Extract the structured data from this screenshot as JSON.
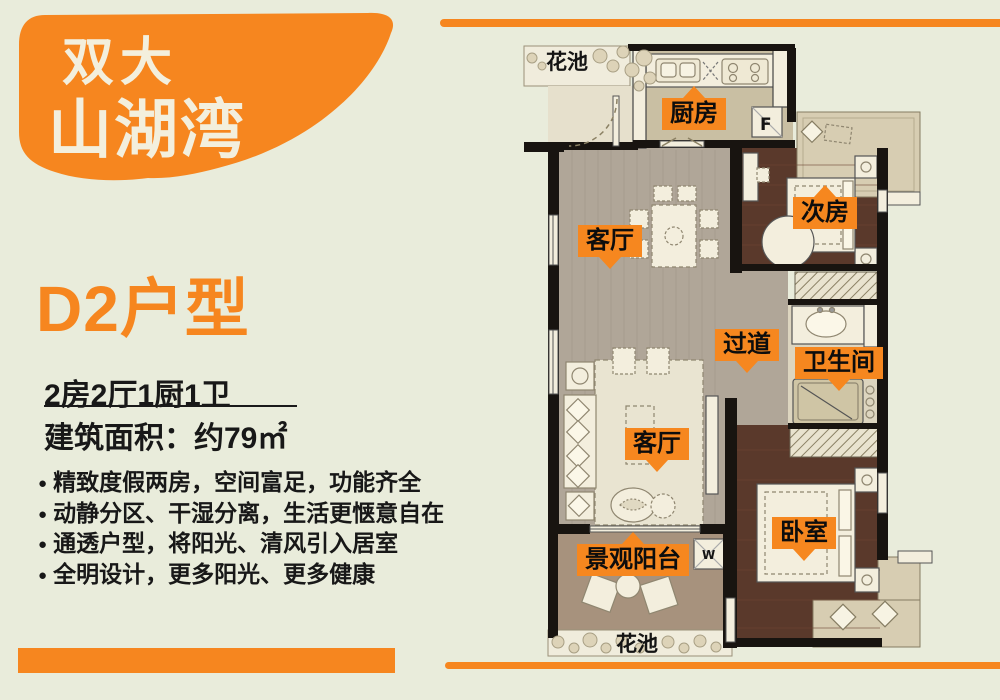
{
  "page": {
    "background": "#e9ecdb",
    "accent": "#f6861f"
  },
  "brand": {
    "line1": "双大",
    "line2": "山湖湾"
  },
  "unit": {
    "title": "D2户型",
    "spec": "2房2厅1厨1卫",
    "area_label": "建筑面积：约79㎡"
  },
  "bullet_char": "●",
  "features": [
    "精致度假两房，空间富足，功能齐全",
    "动静分区、干湿分离，生活更惬意自在",
    "通透户型，将阳光、清风引入居室",
    "全明设计，更多阳光、更多健康"
  ],
  "plan": {
    "labels": {
      "flower_bed_top": "花池",
      "kitchen": "厨房",
      "second_bedroom": "次房",
      "living_dining": "客厅",
      "corridor": "过道",
      "bathroom": "卫生间",
      "living_room": "客厅",
      "master_bedroom": "卧室",
      "balcony": "景观阳台",
      "flower_bed_bottom": "花池",
      "fridge_mark": "F",
      "washer_mark": "W"
    }
  },
  "colors": {
    "accent": "#f6861f",
    "background": "#e9ecdb",
    "wall": "#181410",
    "dark_wood_floor": "#5a392b",
    "living_floor": "#b0a698",
    "kitchen_floor": "#c9bfa3",
    "bath_floor": "#ddd5bf",
    "balcony_floor": "#a7927d",
    "bay_window": "#d7cdb2",
    "flower_strip": "#f0ecdc",
    "furniture": "#f3eedd"
  }
}
